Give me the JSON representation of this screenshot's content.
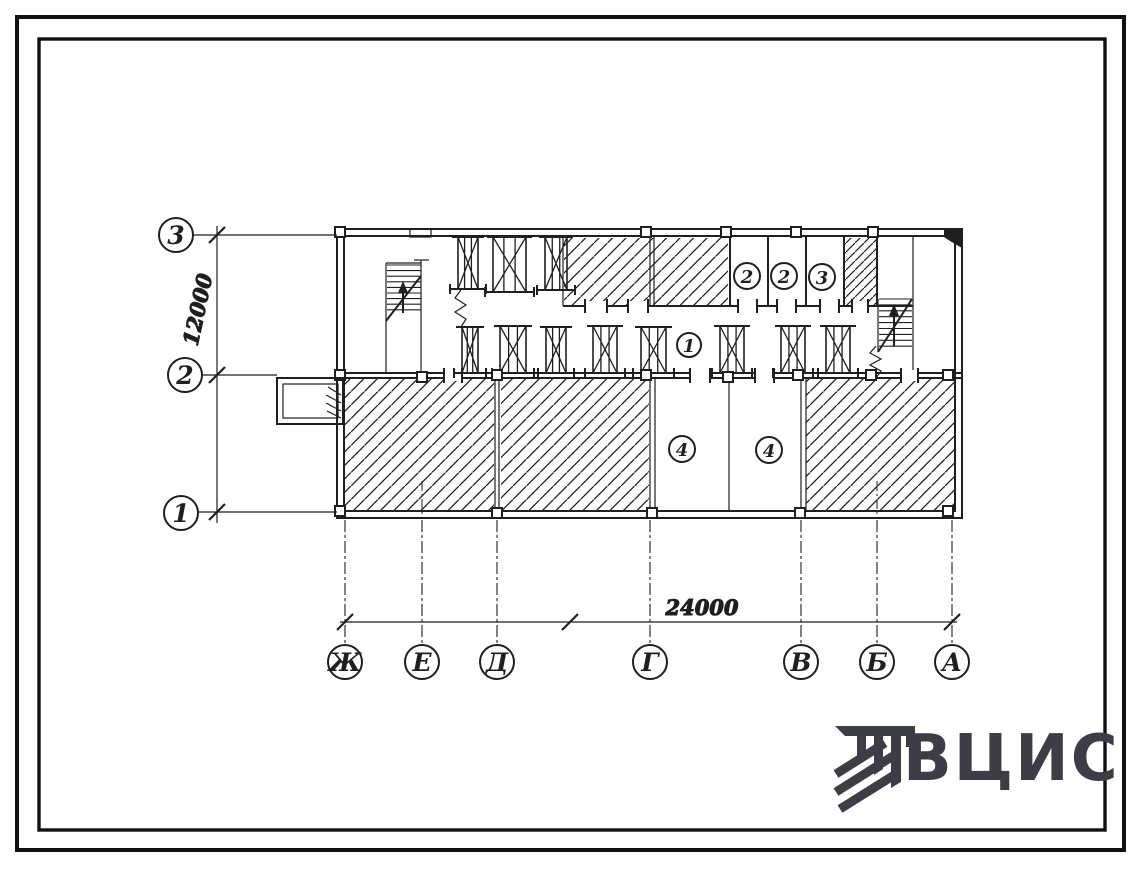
{
  "plan": {
    "row_axes": [
      {
        "label": "3"
      },
      {
        "label": "2"
      },
      {
        "label": "1"
      }
    ],
    "col_axes": [
      {
        "label": "Ж"
      },
      {
        "label": "Е"
      },
      {
        "label": "Д"
      },
      {
        "label": "Г"
      },
      {
        "label": "В"
      },
      {
        "label": "Б"
      },
      {
        "label": "А"
      }
    ],
    "dimensions": {
      "horizontal": "24000",
      "vertical": "12000"
    },
    "room_labels": [
      {
        "label": "2"
      },
      {
        "label": "2"
      },
      {
        "label": "3"
      },
      {
        "label": "1"
      },
      {
        "label": "4"
      },
      {
        "label": "4"
      }
    ]
  },
  "logo": {
    "text": "ВЦИС"
  },
  "colors": {
    "ink": "#1f1f1f",
    "paper": "#ffffff",
    "logo_gray": "#3d3d45"
  }
}
